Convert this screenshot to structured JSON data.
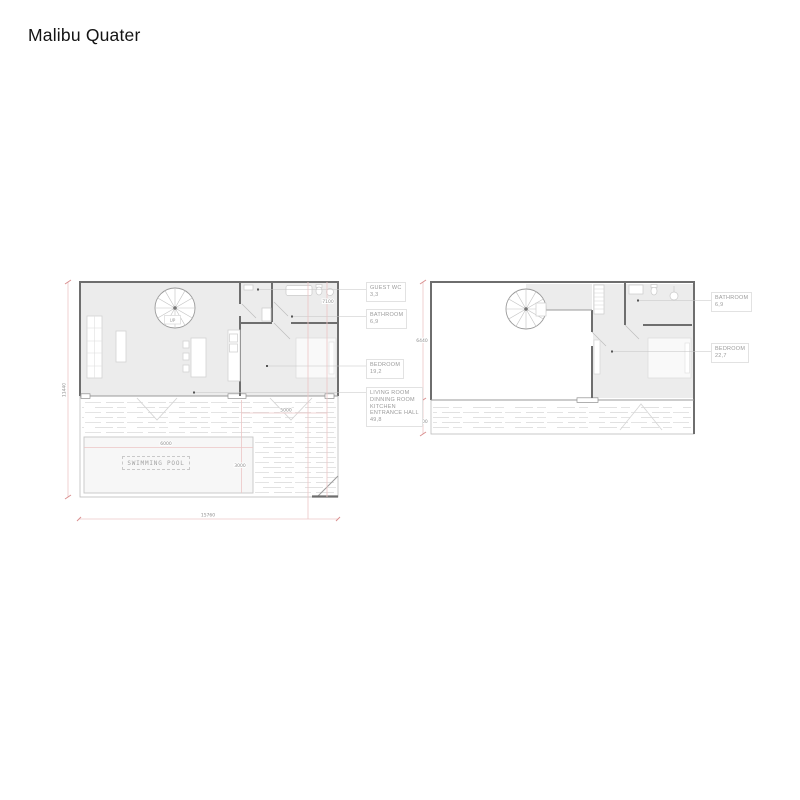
{
  "title": "Malibu Quater",
  "colors": {
    "wall": "#6e6e6e",
    "room_fill": "#ececec",
    "dimension_line": "#ecc6c6",
    "dimension_tick": "#d98f8f",
    "label_text": "#9b9b9b"
  },
  "ground_floor": {
    "stair_label": "UP",
    "pool_label": "SWIMMING POOL",
    "labels": {
      "guest_wc": {
        "name": "GUEST WC",
        "area": "3,3"
      },
      "bathroom": {
        "name": "BATHROOM",
        "area": "6,9"
      },
      "bedroom": {
        "name": "BEDROOM",
        "area": "19,2"
      },
      "living": {
        "lines": [
          "LIVING ROOM",
          "DINNING ROOM",
          "KITCHEN",
          "ENTRANCE HALL"
        ],
        "area": "49,8"
      }
    },
    "dimensions": {
      "height": "11440",
      "width": "15760",
      "interior": "7100",
      "terrace": "5000",
      "pool_width": "6000",
      "pool_depth": "3000"
    }
  },
  "upper_floor": {
    "labels": {
      "bathroom": {
        "name": "BATHROOM",
        "area": "6,9"
      },
      "bedroom": {
        "name": "BEDROOM",
        "area": "22,7"
      }
    },
    "dimensions": {
      "floor_height": "6440",
      "terrace_depth": "1800"
    }
  }
}
